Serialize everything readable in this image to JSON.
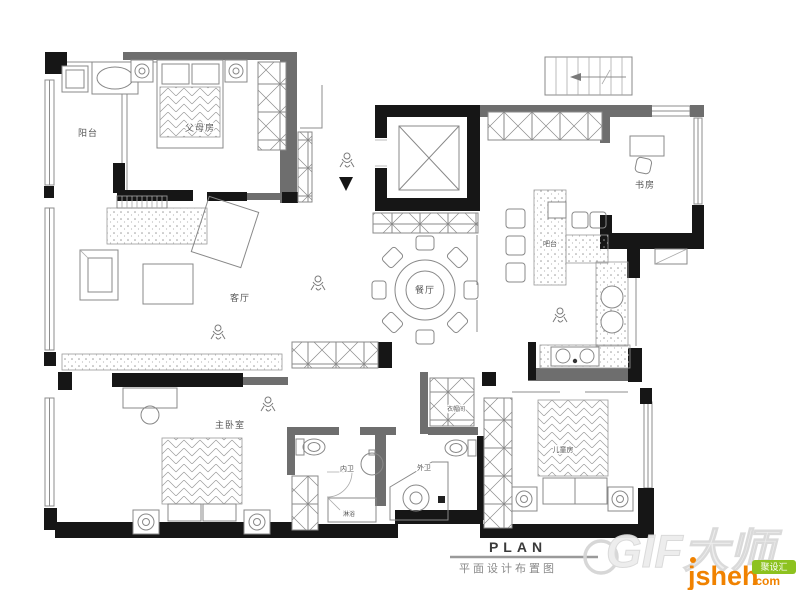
{
  "plan": {
    "rooms": {
      "balcony": "阳台",
      "parents_room": "父母房",
      "study": "书房",
      "bar": "吧台",
      "dining": "餐厅",
      "living": "客厅",
      "master_bedroom": "主卧室",
      "inner_bath": "内卫",
      "outer_bath": "外卫",
      "shower": "淋浴",
      "cloakroom": "衣帽间",
      "kids_room": "儿童房"
    },
    "title_block": {
      "title": "PLAN",
      "subtitle": "平面设计布置图"
    },
    "watermarks": {
      "gif_master": "GIF大师",
      "site_name": "jsheh",
      "site_tld": ".com",
      "site_badge": "聚设汇"
    },
    "colors": {
      "wall_dark": "#161616",
      "wall_gray": "#6e6e6e",
      "line_gray": "#8c8c8c",
      "logo_orange": "#f08200",
      "badge_green": "#8dc21f"
    }
  }
}
